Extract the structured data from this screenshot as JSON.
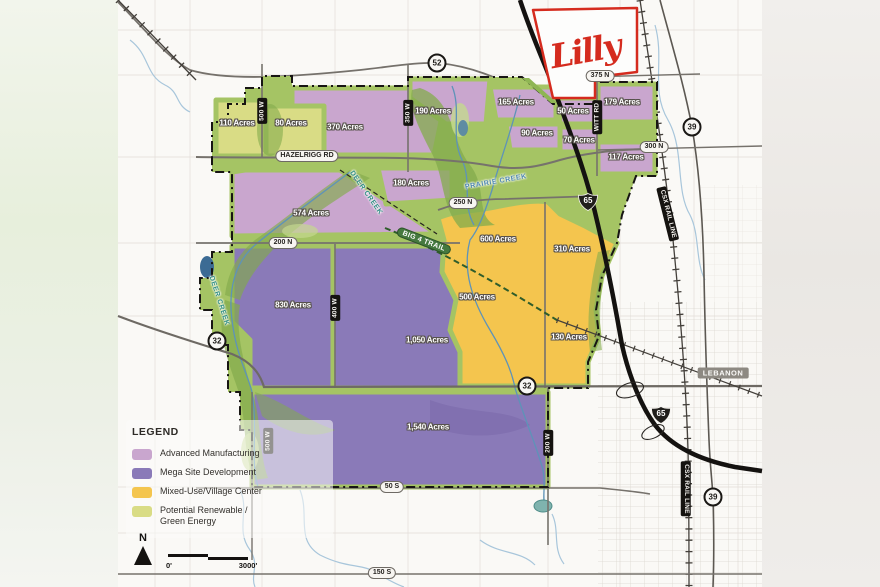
{
  "branding": {
    "lilly": "Lilly"
  },
  "legend": {
    "title": "LEGEND",
    "items": [
      {
        "label": "Advanced Manufacturing",
        "color": "#c9a6ce"
      },
      {
        "label": "Mega Site Development",
        "color": "#8a7ab8"
      },
      {
        "label": "Mixed-Use/Village Center",
        "color": "#f4c54e"
      },
      {
        "label": "Potential Renewable /",
        "label2": "Green Energy",
        "color": "#d9dc85"
      }
    ]
  },
  "parcels": [
    {
      "acres": "110 Acres",
      "zone": "renewable"
    },
    {
      "acres": "80 Acres",
      "zone": "renewable"
    },
    {
      "acres": "370 Acres",
      "zone": "advanced"
    },
    {
      "acres": "190 Acres",
      "zone": "advanced"
    },
    {
      "acres": "165 Acres",
      "zone": "advanced"
    },
    {
      "acres": "50 Acres",
      "zone": "advanced"
    },
    {
      "acres": "179 Acres",
      "zone": "advanced"
    },
    {
      "acres": "90 Acres",
      "zone": "advanced"
    },
    {
      "acres": "70 Acres",
      "zone": "advanced"
    },
    {
      "acres": "117 Acres",
      "zone": "advanced"
    },
    {
      "acres": "574 Acres",
      "zone": "advanced"
    },
    {
      "acres": "180 Acres",
      "zone": "advanced"
    },
    {
      "acres": "830 Acres",
      "zone": "mega"
    },
    {
      "acres": "1,050 Acres",
      "zone": "mega"
    },
    {
      "acres": "1,540 Acres",
      "zone": "mega"
    },
    {
      "acres": "600 Acres",
      "zone": "mixed"
    },
    {
      "acres": "310 Acres",
      "zone": "mixed"
    },
    {
      "acres": "500 Acres",
      "zone": "mixed"
    },
    {
      "acres": "130 Acres",
      "zone": "mixed"
    }
  ],
  "roads": {
    "hazelrigg": "HAZELRIGG RD",
    "n250": "250 N",
    "n200": "200 N",
    "n375": "375 N",
    "n300": "300 N",
    "s50": "50 S",
    "s150": "150 S",
    "w500_top": "500 W",
    "w500_bottom": "500 W",
    "w350": "350 W",
    "w400": "400 W",
    "w200": "200 W",
    "witt": "WITT RD",
    "csx_upper": "CSX RAIL LINE",
    "csx_lower": "CSX RAIL LINE"
  },
  "shields": {
    "us52": "52",
    "sr39": "39",
    "sr32": "32",
    "i65": "65"
  },
  "creeks": {
    "prairie": "PRAIRIE CREEK",
    "deer_upper": "DEER CREEK",
    "deer_lower": "DEER CREEK"
  },
  "trail": {
    "big4": "BIG 4 TRAIL"
  },
  "city": {
    "lebanon": "LEBANON"
  },
  "scale": {
    "north": "N",
    "zero": "0'",
    "three_thousand": "3000'"
  },
  "colors": {
    "advanced_manufacturing": "#c9a6ce",
    "mega_site": "#8a7ab8",
    "mixed_use": "#f4c54e",
    "renewable": "#d9dc85",
    "green_corridor": "#a5c464",
    "lilly_red": "#d52b1e",
    "map_background": "#faf9f6"
  }
}
